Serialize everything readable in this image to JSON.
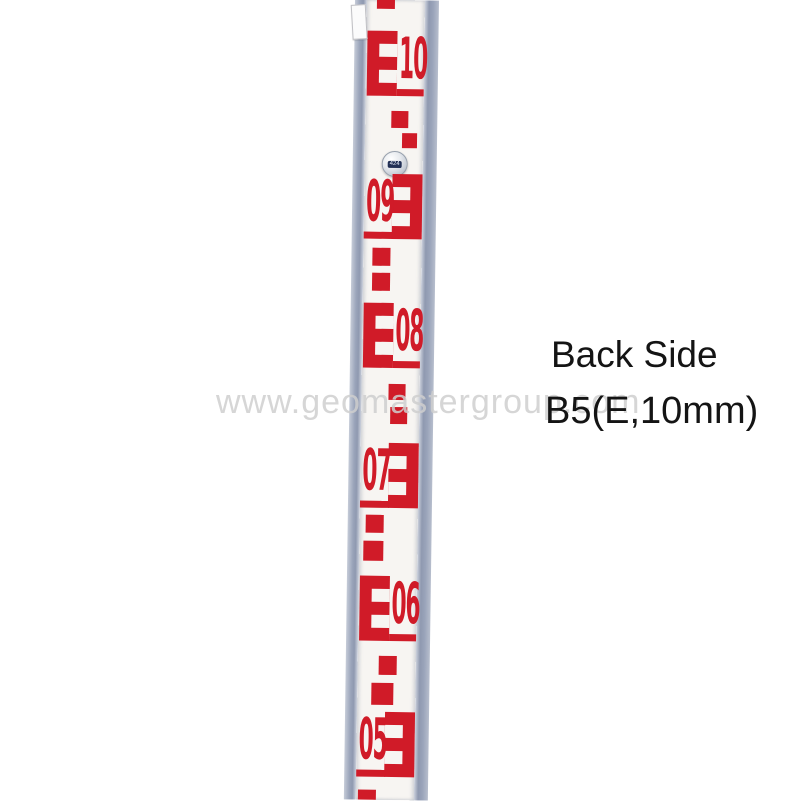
{
  "page": {
    "background": "#ffffff"
  },
  "watermark": {
    "text": "www.geomastergroup.com",
    "color": "#cfcfcf"
  },
  "caption": {
    "line1": "Back Side",
    "line2": "B5(E,10mm)",
    "color": "#141414"
  },
  "staff": {
    "description": "leveling-staff-back-side-E-pattern",
    "red": "#d01b28",
    "face": "#f7f5f2",
    "rivet_label": "424",
    "groups": [
      {
        "digits": "10",
        "e_side": "left",
        "top": 31
      },
      {
        "digits": "09",
        "e_side": "right",
        "top": 174
      },
      {
        "digits": "08",
        "e_side": "left",
        "top": 303
      },
      {
        "digits": "07",
        "e_side": "right",
        "top": 443
      },
      {
        "digits": "06",
        "e_side": "left",
        "top": 576
      },
      {
        "digits": "05",
        "e_side": "right",
        "top": 712
      }
    ],
    "squares": [
      {
        "x": 10,
        "y": 0,
        "w": 18,
        "h": 9
      },
      {
        "x": 26,
        "y": 111,
        "w": 17,
        "h": 17
      },
      {
        "x": 37,
        "y": 133,
        "w": 15,
        "h": 15
      },
      {
        "x": 9,
        "y": 248,
        "w": 18,
        "h": 18
      },
      {
        "x": 9,
        "y": 273,
        "w": 18,
        "h": 18
      },
      {
        "x": 27,
        "y": 384,
        "w": 17,
        "h": 16
      },
      {
        "x": 29,
        "y": 407,
        "w": 17,
        "h": 17
      },
      {
        "x": 6,
        "y": 515,
        "w": 18,
        "h": 18
      },
      {
        "x": 4,
        "y": 541,
        "w": 20,
        "h": 20
      },
      {
        "x": 21,
        "y": 656,
        "w": 18,
        "h": 19
      },
      {
        "x": 14,
        "y": 683,
        "w": 22,
        "h": 22
      },
      {
        "x": 2,
        "y": 790,
        "w": 18,
        "h": 10
      }
    ]
  }
}
